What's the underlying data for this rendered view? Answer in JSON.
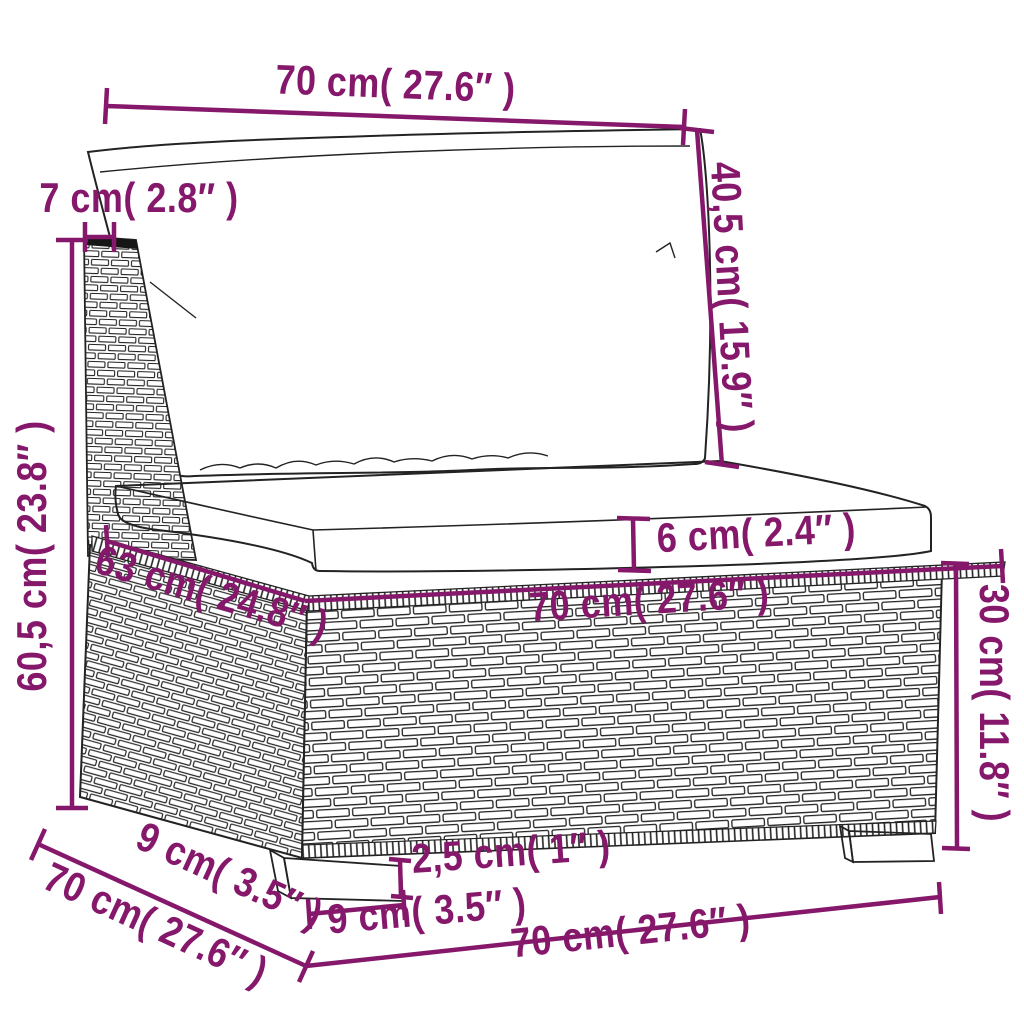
{
  "diagram": {
    "description": "Dimension diagram of a poly rattan garden sofa middle section with back cushion and seat cushion",
    "dimension_color": "#85186B",
    "line_color": "#232323",
    "background": "#ffffff",
    "labels": {
      "top_width": "70 cm( 27.6″ )",
      "back_cushion_height": "40,5 cm( 15.9″ )",
      "back_thickness": "7 cm( 2.8″ )",
      "overall_height": "60,5 cm( 23.8″ )",
      "cushion_thickness": "6 cm( 2.4″ )",
      "seat_depth": "63 cm( 24.8″ )",
      "seat_width": "70 cm( 27.6″ )",
      "base_height": "30 cm( 11.8″ )",
      "bottom_depth": "70 cm( 27.6″ )",
      "leg_offset_diagonal": "9 cm( 3.5″ )",
      "leg_height": "2,5 cm( 1″ )",
      "leg_width": "9 cm( 3.5″ )",
      "bottom_width": "70 cm( 27.6″ )"
    },
    "measurements": [
      {
        "part": "back cushion width",
        "cm": "70",
        "inches": "27.6"
      },
      {
        "part": "back cushion height",
        "cm": "40,5",
        "inches": "15.9"
      },
      {
        "part": "back panel thickness",
        "cm": "7",
        "inches": "2.8"
      },
      {
        "part": "overall height",
        "cm": "60,5",
        "inches": "23.8"
      },
      {
        "part": "seat cushion thickness",
        "cm": "6",
        "inches": "2.4"
      },
      {
        "part": "seat depth",
        "cm": "63",
        "inches": "24.8"
      },
      {
        "part": "seat width",
        "cm": "70",
        "inches": "27.6"
      },
      {
        "part": "base height",
        "cm": "30",
        "inches": "11.8"
      },
      {
        "part": "base depth",
        "cm": "70",
        "inches": "27.6"
      },
      {
        "part": "leg offset",
        "cm": "9",
        "inches": "3.5"
      },
      {
        "part": "leg height",
        "cm": "2,5",
        "inches": "1"
      },
      {
        "part": "leg width",
        "cm": "9",
        "inches": "3.5"
      },
      {
        "part": "base width",
        "cm": "70",
        "inches": "27.6"
      }
    ]
  }
}
